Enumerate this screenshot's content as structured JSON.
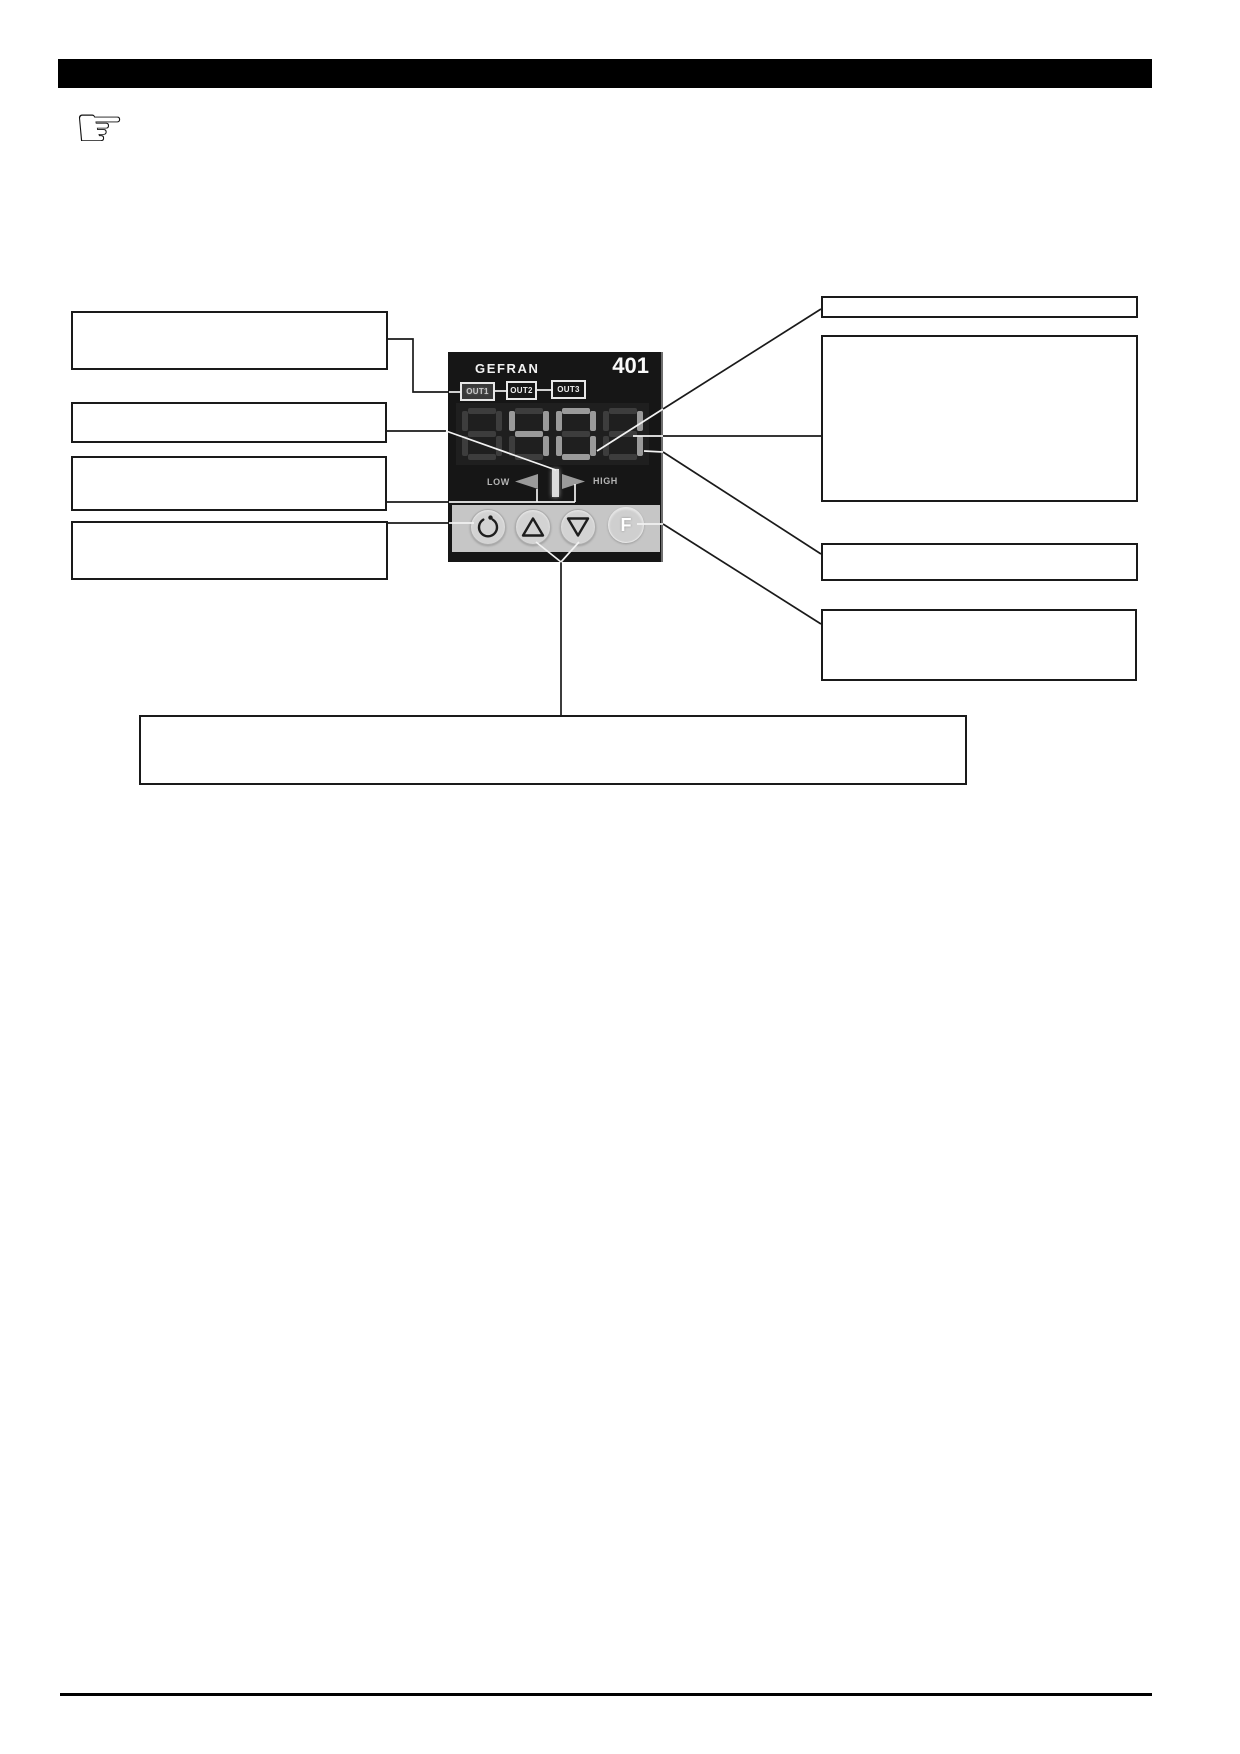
{
  "page": {
    "background": "#ffffff",
    "kind": "manual-diagram-page"
  },
  "header": {
    "bar_color": "#000000"
  },
  "note_icon": {
    "glyph": "☞"
  },
  "device": {
    "brand": "GEFRAN",
    "model": "401",
    "indicators": [
      {
        "label": "OUT1",
        "lit": true
      },
      {
        "label": "OUT2",
        "lit": false
      },
      {
        "label": "OUT3",
        "lit": false
      }
    ],
    "display": {
      "value": "401",
      "digits": [
        {
          "char": "8",
          "lit": false
        },
        {
          "char": "4",
          "lit": true
        },
        {
          "char": "0",
          "lit": true
        },
        {
          "char": "1",
          "lit": true
        }
      ],
      "segment_color_lit": "#9a9a9a",
      "segment_color_dim": "#3d3d3d"
    },
    "deviation": {
      "low_label": "LOW",
      "high_label": "HIGH",
      "arrow_color": "#9a9a9a",
      "bar_color": "#dcdcdc"
    },
    "buttons": [
      {
        "name": "power"
      },
      {
        "name": "raise"
      },
      {
        "name": "lower"
      },
      {
        "name": "function",
        "label": "F"
      }
    ]
  },
  "callouts": {
    "left": [
      {
        "text": ""
      },
      {
        "text": ""
      },
      {
        "text": ""
      },
      {
        "text": ""
      }
    ],
    "right": [
      {
        "text": ""
      },
      {
        "text": ""
      },
      {
        "text": ""
      },
      {
        "text": ""
      }
    ],
    "bottom": {
      "text": ""
    }
  },
  "colors": {
    "panel": "#161616",
    "keypad": "#c6c6c6",
    "leader_line_dark": "#1a1a1a",
    "leader_line_light": "#f2f2f2"
  }
}
